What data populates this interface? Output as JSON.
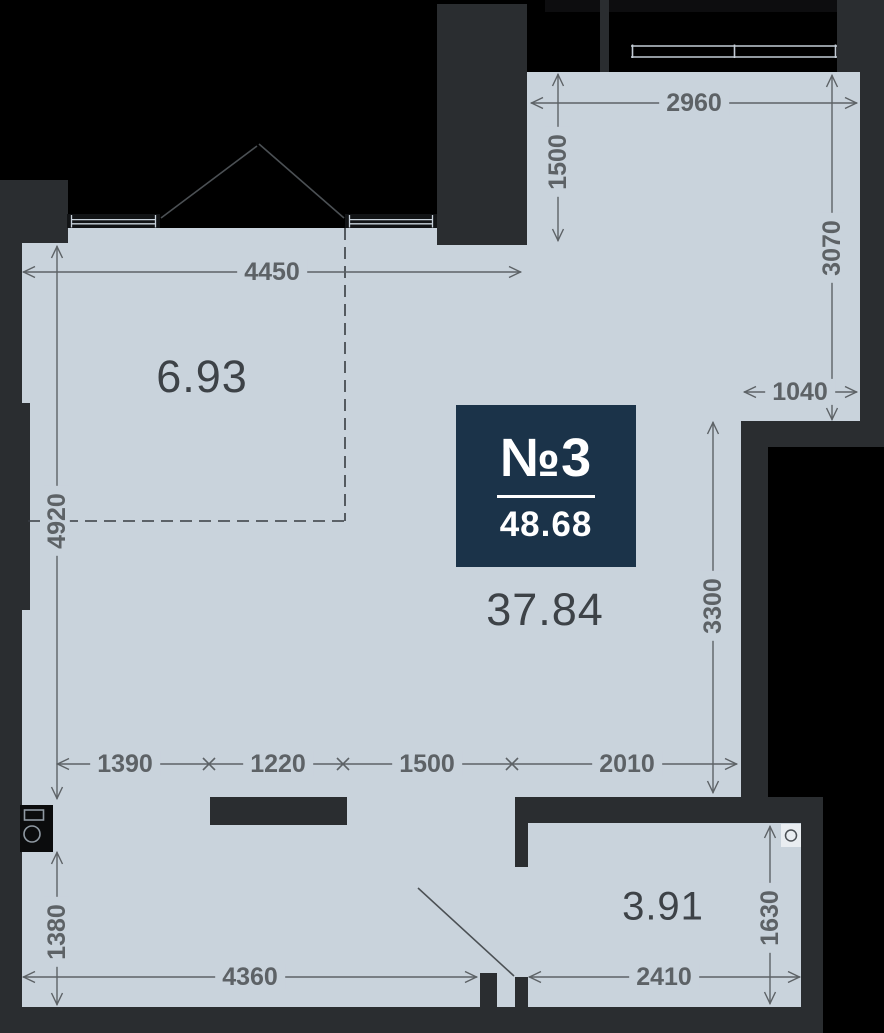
{
  "unit_badge": {
    "number": "№3",
    "total_area": "48.68"
  },
  "areas": {
    "zone": "6.93",
    "main": "37.84",
    "bathroom": "3.91"
  },
  "dimensions": {
    "alcove_width": "2960",
    "alcove_depth": "1500",
    "right_upper_height": "3070",
    "right_niche_width": "1040",
    "upper_width": "4450",
    "left_height": "4920",
    "right_lower_height": "3300",
    "chain": [
      "1390",
      "1220",
      "1500",
      "2010"
    ],
    "lower_left_height": "1380",
    "bottom_width": "4360",
    "bathroom_width": "2410",
    "bathroom_height": "1630"
  },
  "icons": {
    "bathroom_vent": "circle-in-square",
    "kitchen_shaft": "box-with-circle-and-rect",
    "windows": "triple-bar-window",
    "doors": "open-leaf-swing-lines"
  },
  "colors": {
    "floor": "#c9d3dc",
    "wall": "#2a2d30",
    "outside": "#000000",
    "badge_bg": "#1b3349",
    "badge_text": "#ffffff",
    "dimension_text": "#5d6266",
    "area_text": "#3d4247"
  }
}
